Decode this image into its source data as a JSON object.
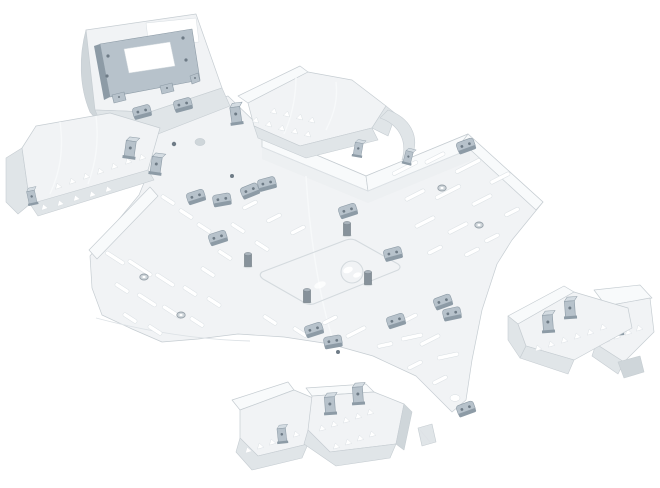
{
  "page": {
    "title": "ATV skid plate kit product render"
  },
  "product_image": {
    "alt": "Exploded 3D render of an aluminium ATV underbody skid-plate protection kit with steel mounting hardware on a white background",
    "parts": [
      {
        "id": "winch-mount-plate",
        "label": "Winch mount plate with steel winch bracket"
      },
      {
        "id": "front-left-arm-guard",
        "label": "Front left A-arm guard with triangular vents"
      },
      {
        "id": "front-right-arm-guard",
        "label": "Front right A-arm guard with triangular vents"
      },
      {
        "id": "main-skid-plate",
        "label": "Central skid plate with slotted vents, clamps and standoffs"
      },
      {
        "id": "rear-arm-guards",
        "label": "Pair of rear A-arm guards with steel angle brackets"
      },
      {
        "id": "footpeg-guards",
        "label": "Pair of footpeg guards with steel angle brackets"
      }
    ]
  },
  "colors": {
    "background": "#ffffff",
    "plate_top": "#f1f3f5",
    "plate_top_light": "#f8fafb",
    "plate_side": "#e0e5e8",
    "plate_side_dark": "#cfd6da",
    "plate_edge": "#c6cdd2",
    "slot_fill": "#ffffff",
    "steel_light": "#d4dce2",
    "steel_mid": "#b7c2cb",
    "steel_dark": "#8d9ba6",
    "steel_hole": "#6e7b86",
    "cylinder_mid": "#87929b"
  }
}
